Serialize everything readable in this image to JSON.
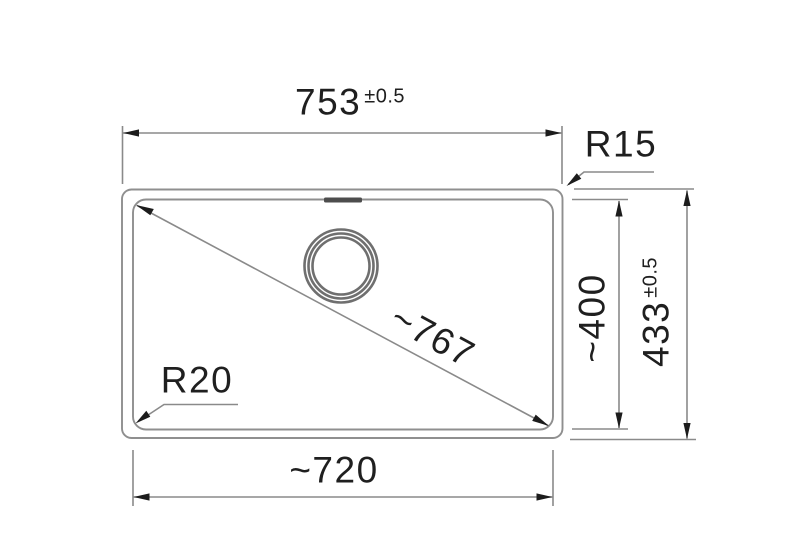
{
  "colors": {
    "background": "#ffffff",
    "drawing_line": "#8c8c8c",
    "arrow_and_text": "#1f1f1f",
    "drain_ring": "#6f6f6f",
    "overflow_slot": "#4d4d4d"
  },
  "labels": {
    "width_top": {
      "value": "753",
      "tolerance": "±0.5"
    },
    "corner_radius_outer": "R15",
    "height_inner": "~400",
    "height_outer": {
      "value": "433",
      "tolerance": "±0.5"
    },
    "diagonal": "~767",
    "corner_radius_inner": "R20",
    "width_bottom": "~720"
  }
}
